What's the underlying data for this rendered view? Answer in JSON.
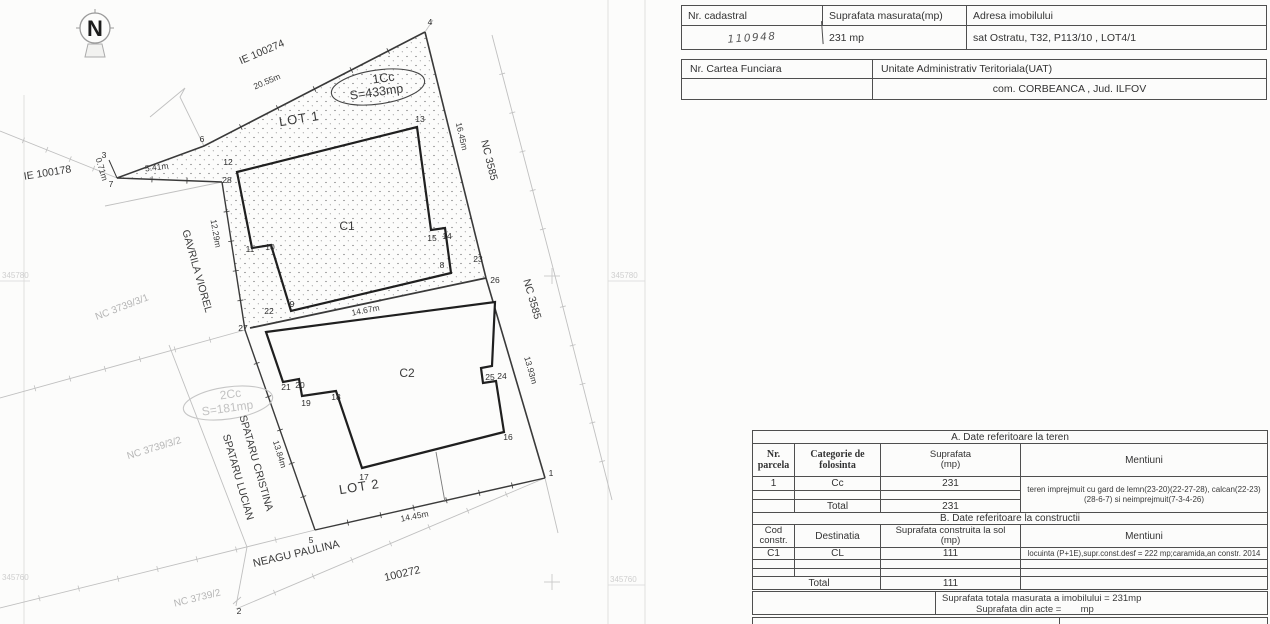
{
  "doc": {
    "t1": {
      "h_nr": "Nr.  cadastral",
      "h_sup": "Suprafata  masurata(mp)",
      "h_adr": "Adresa  imobilului",
      "v_nr": "110948",
      "v_sup": "231 mp",
      "v_adr": "sat Ostratu, T32, P113/10 , LOT4/1"
    },
    "t2": {
      "h_cf": "Nr. Cartea  Funciara",
      "h_uat": "Unitate Administrativ Teritoriala(UAT)",
      "v_uat": "com. CORBEANCA , Jud. ILFOV"
    },
    "a": {
      "title": "A.  Date referitoare la teren",
      "h_nr": "Nr.\nparcela",
      "h_cat": "Categorie de\nfolosinta",
      "h_sup": "Suprafata\n(mp)",
      "h_ment": "Mentiuni",
      "r1_nr": "1",
      "r1_cat": "Cc",
      "r1_sup": "231",
      "r1_ment": "teren imprejmuit cu gard de lemn(23-20)(22-27-28), calcan(22-23)(28-6-7) si neimprejmuit(7-3-4-26)",
      "total_label": "Total",
      "total_sup": "231"
    },
    "b": {
      "title": "B.  Date referitoare la constructii",
      "h_cod": "Cod\nconstr.",
      "h_dest": "Destinatia",
      "h_sup": "Suprafata construita la sol\n(mp)",
      "h_ment": "Mentiuni",
      "r1_cod": "C1",
      "r1_dest": "CL",
      "r1_sup": "111",
      "r1_ment": "locuinta (P+1E),supr.const.desf = 222 mp;caramida,an constr. 2014",
      "total_label": "Total",
      "total_sup": "111"
    },
    "footer": {
      "line1": "Suprafata  totala  masurata a imobilului =  231mp",
      "line2_label": "Suprafata  din  acte =",
      "line2_unit": "mp"
    }
  },
  "map": {
    "compass": "N",
    "areas": {
      "lot1": "LOT 1",
      "lot2": "LOT 2",
      "c1": "C1",
      "c2": "C2",
      "cc1": "1Cc",
      "s1": "S=433mp",
      "cc2": "2Cc",
      "s2": "S=181mp"
    },
    "names": {
      "ie100274": "IE 100274",
      "ie100178": "IE 100178",
      "nc3585a": "NC 3585",
      "nc3585b": "NC 3585",
      "nc3739_3_1": "NC 3739/3/1",
      "nc3739_3_2": "NC 3739/3/2",
      "nc3739_2": "NC 3739/2",
      "gavrila": "GAVRILA VIOREL",
      "spataru1": "SPATARU CRISTINA",
      "spataru2": "SPATARU LUCIAN",
      "neagu": "NEAGU PAULINA",
      "n100272": "100272"
    },
    "dims": {
      "d0_71": "0.71m",
      "d5_41": "5.41m",
      "d20_55": "20.55m",
      "d16_45": "16.45m",
      "d12_29": "12.29m",
      "d14_67": "14.67m",
      "d13_93": "13.93m",
      "d13_84": "13.84m",
      "d14_45": "14.45m"
    },
    "grid": {
      "tl": "345780",
      "bl": "345760",
      "tr": "345780",
      "br": "345760"
    },
    "points": {
      "p1": "1",
      "p2": "2",
      "p3": "3",
      "p4": "4",
      "p5": "5",
      "p6": "6",
      "p7": "7",
      "p8": "8",
      "p9": "9",
      "p10": "10",
      "p11": "11",
      "p12": "12",
      "p13": "13",
      "p14": "14",
      "p15": "15",
      "p16": "16",
      "p17": "17",
      "p18": "18",
      "p19": "19",
      "p20": "20",
      "p21": "21",
      "p22": "22",
      "p23": "23",
      "p24": "24",
      "p25": "25",
      "p26": "26",
      "p27": "27",
      "p28": "28"
    }
  }
}
